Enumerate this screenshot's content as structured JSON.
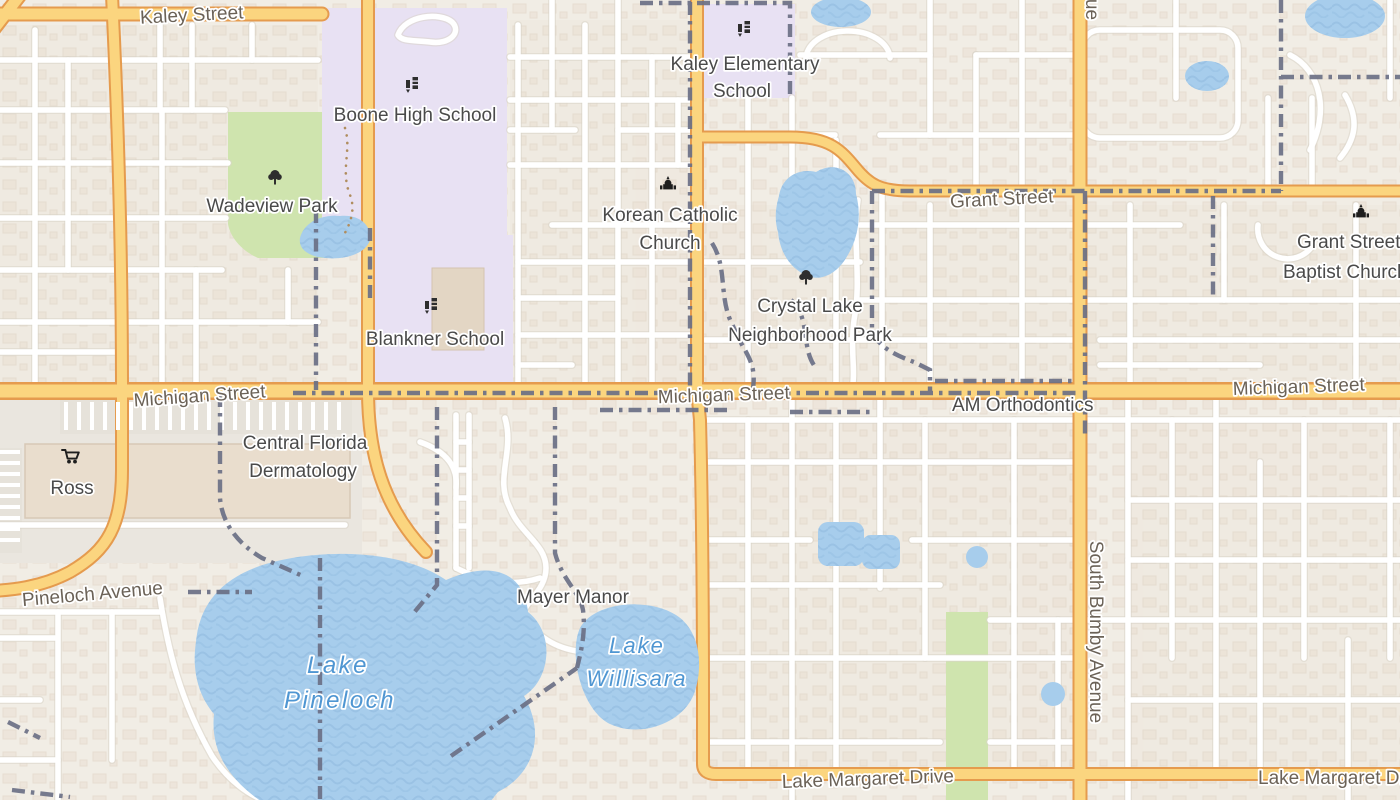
{
  "map": {
    "labels": {
      "kaley_street": "Kaley Street",
      "boone_high_school": "Boone High School",
      "wadeview_park": "Wadeview Park",
      "kaley_elementary_line1": "Kaley Elementary",
      "kaley_elementary_line2": "School",
      "korean_catholic_line1": "Korean Catholic",
      "korean_catholic_line2": "Church",
      "grant_street": "Grant Street",
      "grant_baptist_line1": "Grant Street",
      "grant_baptist_line2": "Baptist Church",
      "blankner_school": "Blankner School",
      "crystal_lake_line1": "Crystal Lake",
      "crystal_lake_line2": "Neighborhood Park",
      "michigan_street": "Michigan Street",
      "am_orthodontics": "AM Orthodontics",
      "ross": "Ross",
      "central_florida_line1": "Central Florida",
      "central_florida_line2": "Dermatology",
      "pineloch_avenue": "Pineloch Avenue",
      "mayer_manor": "Mayer Manor",
      "lake_pineloch_line1": "Lake",
      "lake_pineloch_line2": "Pineloch",
      "lake_willisara_line1": "Lake",
      "lake_willisara_line2": "Willisara",
      "south_bumby_avenue": "South Bumby Avenue",
      "avenue_partial": "Avenue",
      "lake_margaret_drive": "Lake Margaret Drive"
    },
    "icons": [
      "school-icon",
      "church-icon",
      "tree-icon",
      "shopping-cart-icon"
    ],
    "colors": {
      "land": "#f1ede5",
      "block_tint": "#efe7dd",
      "building": "#e7dbcc",
      "building_outline": "#d8c8b6",
      "water": "#a7cdec",
      "water_wave": "#93bce0",
      "park": "#cfe4ae",
      "school": "#e8e1f3",
      "plaza": "#eae6df",
      "road_major": "#fbd57f",
      "road_major_casing": "#e59b4e",
      "road_minor": "#ffffff",
      "boundary": "#6b7086",
      "water_label": "#4f96d2",
      "road_label": "#6b6257",
      "poi_label": "#4a4a4a"
    }
  }
}
